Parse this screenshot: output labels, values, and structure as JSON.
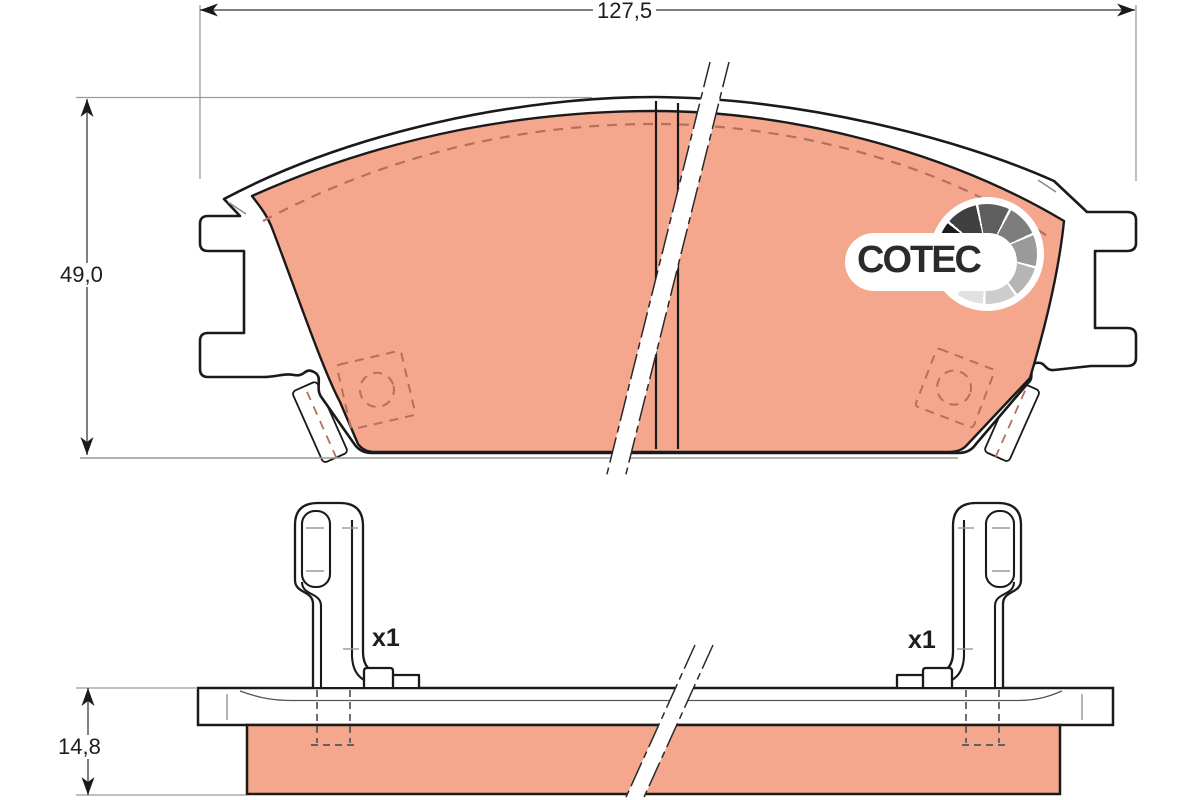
{
  "drawing": {
    "type": "brake-pad-set-technical-drawing",
    "views": [
      "front-view",
      "side-view"
    ]
  },
  "dimensions": {
    "width": "127,5",
    "height": "49,0",
    "thickness": "14,8"
  },
  "clips": {
    "left_qty": "x1",
    "right_qty": "x1"
  },
  "logo": {
    "name": "COTEC"
  },
  "colors": {
    "friction": "#f4a78d",
    "outline": "#1a1a1a",
    "hidden_detail": "#b5705a",
    "dim_line": "#555555",
    "extension_line": "#9a9a9a"
  }
}
